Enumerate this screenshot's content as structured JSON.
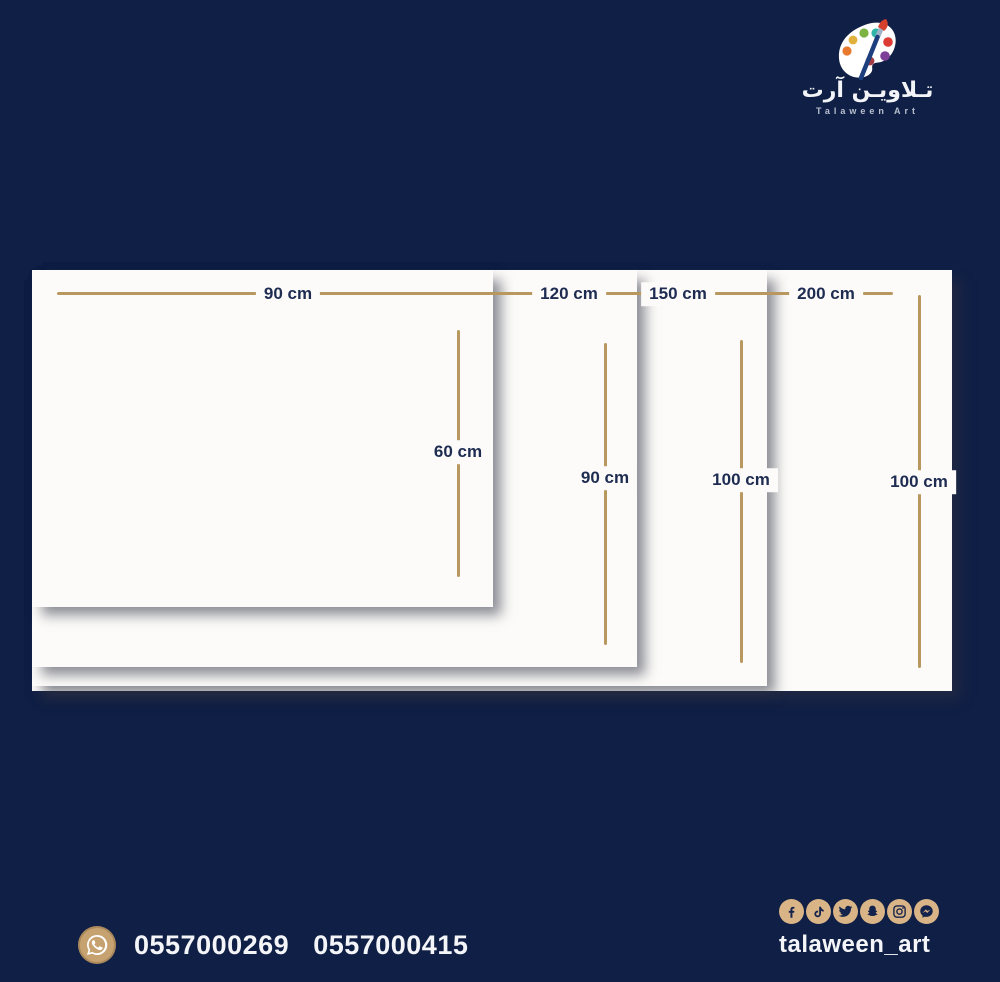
{
  "brand": {
    "name_arabic": "تـلاويـن آرت",
    "name_english": "Talaween Art"
  },
  "panels": [
    {
      "name": "90x60",
      "width_label": "90 cm",
      "height_label": "60 cm"
    },
    {
      "name": "120x90",
      "width_label": "120 cm",
      "height_label": "90 cm"
    },
    {
      "name": "150x100",
      "width_label": "150 cm",
      "height_label": "100 cm"
    },
    {
      "name": "200x100",
      "width_label": "200 cm",
      "height_label": "100 cm"
    }
  ],
  "contact": {
    "phone_1": "0557000269",
    "phone_2": "0557000415"
  },
  "social": {
    "handle": "talaween_art",
    "platforms": [
      "facebook",
      "tiktok",
      "twitter",
      "snapchat",
      "instagram",
      "messenger"
    ]
  },
  "colors": {
    "background": "#101f45",
    "measure_line": "#b8985f",
    "panel": "#fcfbf9",
    "label_text": "#1e2c52",
    "icon_circle": "#d8b487",
    "whatsapp_circle": "#c7a271"
  }
}
